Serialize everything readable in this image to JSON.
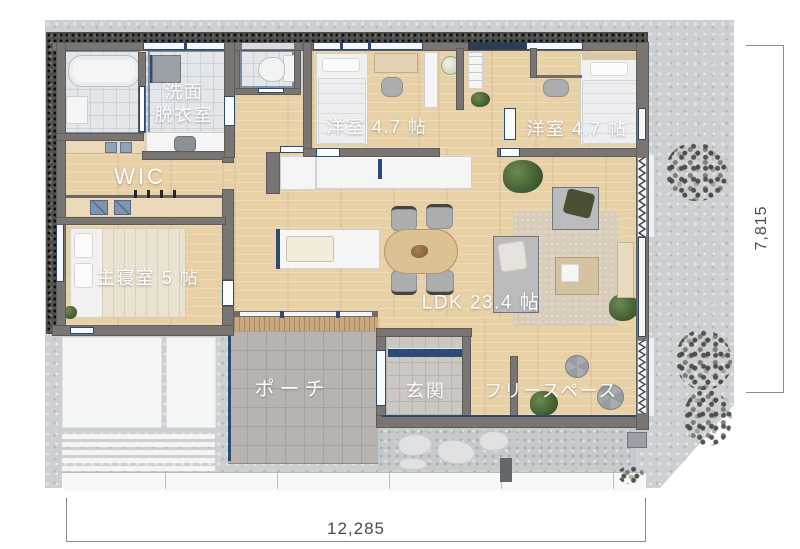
{
  "palette": {
    "site": "#cdd0d2",
    "wall": "#787572",
    "navy_accent": "#2b4a74",
    "wood_floor": "#e9d1a7",
    "porch_tile": "#b7b3ae",
    "genkan_tile": "#cbc8c4",
    "wet_tile": "#e4e7ea",
    "rug": "#d8cdbb",
    "label_text": "#ffffff",
    "dimension_text": "#4b4b4b"
  },
  "rooms": {
    "washroom": {
      "label_line1": "洗面",
      "label_line2": "脱衣室"
    },
    "wic": {
      "label": "WIC"
    },
    "master_bedroom": {
      "label": "主寝室 5 帖"
    },
    "bedroom_1": {
      "label": "洋室 4.7 帖"
    },
    "bedroom_2": {
      "label": "洋室 4.7 帖"
    },
    "ldk": {
      "label": "LDK 23.4 帖"
    },
    "porch": {
      "label": "ポーチ"
    },
    "entrance": {
      "label": "玄関"
    },
    "free_space": {
      "label": "フリースペース"
    }
  },
  "dimensions": {
    "bottom_mm": "12,285",
    "right_mm": "7,815"
  },
  "icons": {
    "bathtub-icon": "rounded rect css shape",
    "shower-icon": "small rect css shape",
    "washing-machine-icon": "gray square css shape",
    "sink-basin-icon": "rounded square css shape",
    "toilet-icon": "tank + bowl css shapes",
    "bed-icon": "base + pillow + blanket rects",
    "desk-icon": "wood rect",
    "chair-icon": "rounded gray rect",
    "dining-table-icon": "rounded wood rect",
    "kitchen-island-icon": "white rect with navy edge",
    "sofa-icon": "gray rect with cushion",
    "low-table-icon": "tan rect with papers",
    "ottoman-icon": "segmented circle",
    "plant-icon": "green radial blob",
    "bush-icon": "speckled blob",
    "folding-door-icon": "svg zigzag",
    "shoe-cabinet-icon": "navy strip",
    "outdoor-unit-icon": "gray box"
  }
}
